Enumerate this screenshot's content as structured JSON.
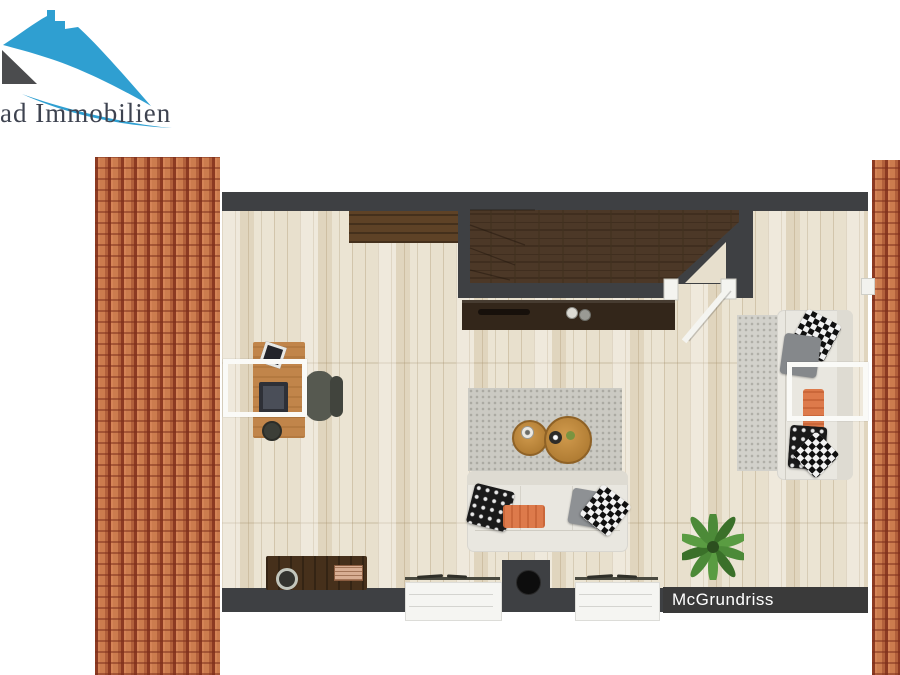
{
  "meta": {
    "type": "real-estate floor plan rendering",
    "view": "top-down 3D attic living room between two clay-tile roof eaves"
  },
  "branding": {
    "logo_text": "rad Immobilien",
    "logo_mark": "blue-roof-house-logo",
    "roof_blue": "#2f9fd1",
    "gable_gray": "#4b4c4e",
    "text_color": "#3e4350"
  },
  "watermark": {
    "label": "McGrundriss",
    "bar_color": "#3a3a3a",
    "text_color": "#ffffff"
  },
  "palette": {
    "wall": "#3e4043",
    "floor_wood": "#e8e0cd",
    "roof_tiles": "#c97748",
    "roof_tile_shadow": "#8c3a22",
    "stair_parquet": "#4c3827",
    "dark_wood_lowboard": "#33261a",
    "desk_wood": "#c1854a",
    "sofa_cream": "#e9e7e0",
    "rug_gray": "#cbcac3",
    "accent_orange": "#dd7a4b",
    "plant_green": "#4c8a38",
    "skylight_frame": "#fafaf7"
  },
  "elements": {
    "left_roof": "clay roof tile strip (left eave)",
    "right_roof": "clay roof tile strip (right eave)",
    "stairwell": "dark parquet stair landing enclosed by walls with open white door",
    "stair_lowboard": "dark sideboard with remote control and two cups",
    "wall_shelf": "wooden shelf along top wall",
    "desk": "wooden desk with monitor, photo frame and mug",
    "desk_chair": "dark office chair",
    "skylight_left": "white roof-window outline over desk area",
    "skylight_right": "white roof-window outline over right sofa",
    "center_rug": "gray rug with two round wooden coffee tables",
    "center_sofa": "cream sofa with patterned pillows and orange throw",
    "right_sofa": "cream sofa with patterned pillows and orange throw",
    "right_rug": "light runner rug",
    "plant": "green potted plant",
    "bottom_sideboard": "dark wood sideboard with bowl and book",
    "window_left": "window in bottom wall",
    "window_right": "window in bottom wall",
    "chimney": "chimney block with round flue"
  }
}
